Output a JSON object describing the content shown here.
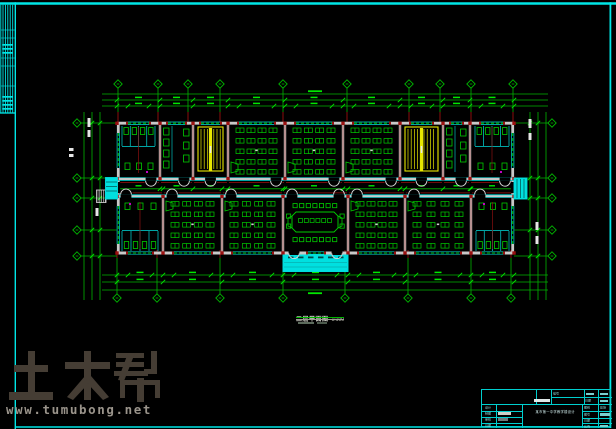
{
  "canvas": {
    "width": 616,
    "height": 429,
    "bg": "#000000"
  },
  "colors": {
    "frame": "#00e6e6",
    "green": "#00b400",
    "green_bright": "#00e800",
    "desk": "#00cc00",
    "wall": "#c8c8c8",
    "cyan": "#00dcdc",
    "cyan_fill": "#00e0e0",
    "yellow": "#e8e800",
    "red": "#9c1010",
    "white": "#e6e6e6",
    "magenta": "#c400c4"
  },
  "watermark": {
    "logo_text": "土木帮",
    "url": "www.tumubong.net",
    "logo_color": "#453d34",
    "url_color": "#9a948b"
  },
  "plan_label": {
    "title": "二层平面图",
    "scale": "1:100"
  },
  "title_block": {
    "project_title": "某市第一中学教学楼设计",
    "left_labels": [
      "设计",
      "制图",
      "审核",
      "日期"
    ],
    "right_labels": [
      "图别",
      "图号",
      "日期",
      "比例"
    ],
    "right_value": "建施",
    "top_labels": [
      "编号",
      "日期"
    ]
  },
  "plan": {
    "building": {
      "x1": 117,
      "x2": 514,
      "y1": 123,
      "y2": 253,
      "cor_y1": 178,
      "cor_y2": 197
    },
    "top_bays": [
      117,
      160,
      193,
      228,
      285,
      343,
      400,
      443,
      470,
      514
    ],
    "bottom_bays": [
      117,
      163,
      222,
      283,
      348,
      405,
      471,
      514
    ],
    "top_rooms": [
      "toilet",
      "wash",
      "stair",
      "class",
      "class",
      "class",
      "stair",
      "wash",
      "toilet"
    ],
    "bottom_rooms": [
      "toilet",
      "class",
      "class",
      "meeting",
      "class",
      "class",
      "toilet"
    ],
    "axis_top": {
      "y": 84,
      "xs": [
        118,
        158,
        188,
        220,
        283,
        347,
        409,
        440,
        471,
        513
      ]
    },
    "axis_bottom": {
      "y": 298,
      "xs": [
        117,
        157,
        220,
        283,
        345,
        408,
        471,
        511
      ]
    },
    "axis_left": {
      "x": 77,
      "ys": [
        123,
        178,
        198,
        230,
        256
      ]
    },
    "axis_right": {
      "x": 552,
      "ys": [
        123,
        178,
        198,
        230,
        256
      ]
    },
    "dim_top_ys": [
      94,
      100,
      106
    ],
    "dim_bottom_ys": [
      275,
      282,
      290
    ],
    "dim_left_xs": [
      84,
      92,
      100
    ],
    "dim_right_xs": [
      530,
      538,
      546
    ],
    "entr_main": {
      "x1": 283,
      "x2": 348,
      "y1": 255,
      "y2": 271.5
    },
    "entr_left": {
      "x1": 105.5,
      "x2": 117.5,
      "y1": 177.5,
      "y2": 199
    },
    "entr_right": {
      "x1": 514,
      "x2": 527,
      "y1": 178,
      "y2": 199
    }
  }
}
